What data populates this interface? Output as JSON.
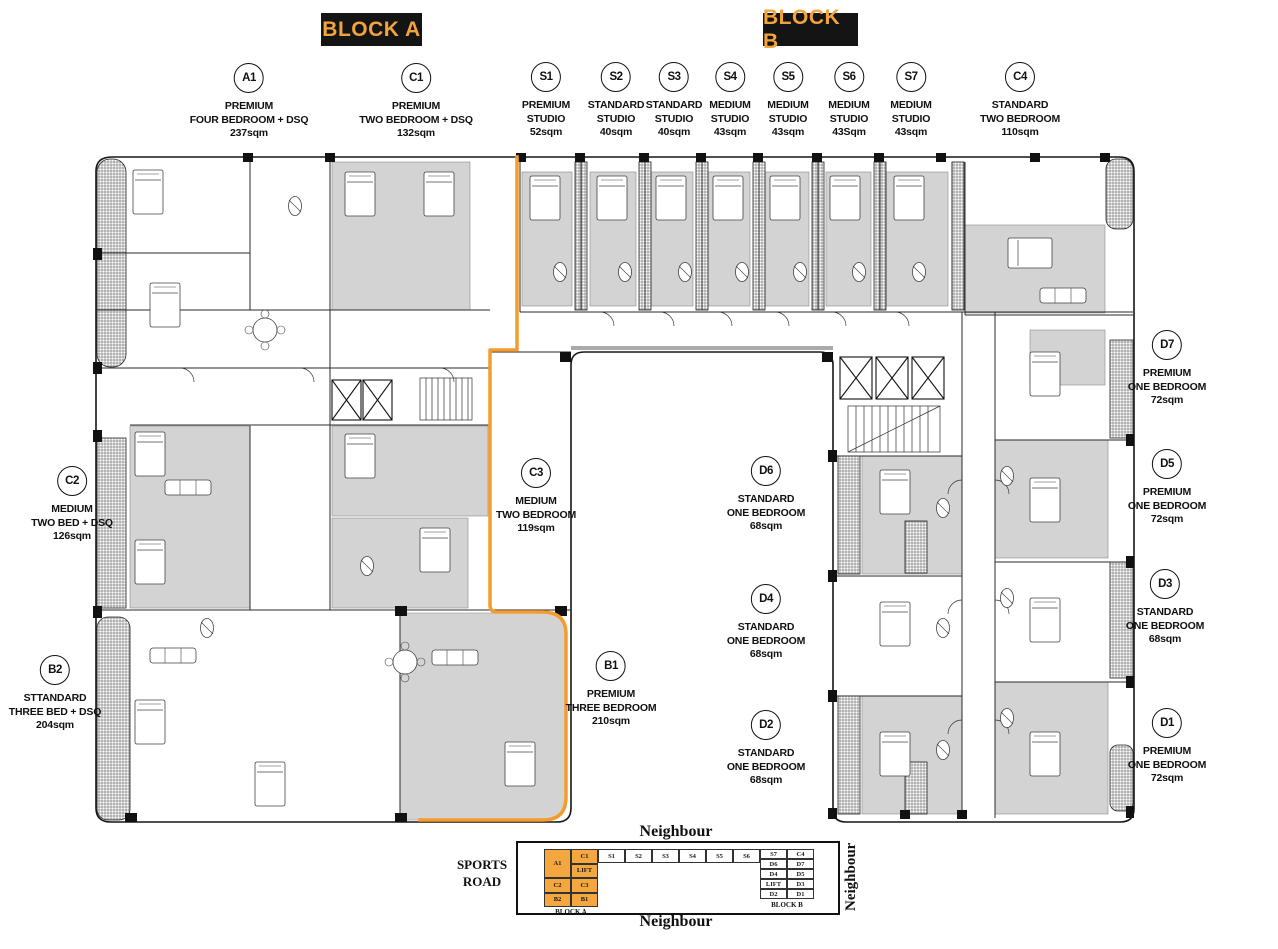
{
  "poster": {
    "block_a_header": "BLOCK A",
    "block_b_header": "BLOCK B"
  },
  "colors": {
    "header_bg": "#141414",
    "accent_orange": "#F2A33C",
    "highlight_orange": "#F59C2F",
    "keyplan_orange": "#F3A73E",
    "plan_room_gray": "#D3D3D3"
  },
  "units": [
    {
      "code": "A1",
      "lines": [
        "PREMIUM",
        "FOUR BEDROOM + DSQ",
        "237sqm"
      ]
    },
    {
      "code": "C1",
      "lines": [
        "PREMIUM",
        "TWO BEDROOM + DSQ",
        "132sqm"
      ]
    },
    {
      "code": "S1",
      "lines": [
        "PREMIUM",
        "STUDIO",
        "52sqm"
      ]
    },
    {
      "code": "S2",
      "lines": [
        "STANDARD",
        "STUDIO",
        "40sqm"
      ]
    },
    {
      "code": "S3",
      "lines": [
        "STANDARD",
        "STUDIO",
        "40sqm"
      ]
    },
    {
      "code": "S4",
      "lines": [
        "MEDIUM",
        "STUDIO",
        "43sqm"
      ]
    },
    {
      "code": "S5",
      "lines": [
        "MEDIUM",
        "STUDIO",
        "43sqm"
      ]
    },
    {
      "code": "S6",
      "lines": [
        "MEDIUM",
        "STUDIO",
        "43Sqm"
      ]
    },
    {
      "code": "S7",
      "lines": [
        "MEDIUM",
        "STUDIO",
        "43sqm"
      ]
    },
    {
      "code": "C4",
      "lines": [
        "STANDARD",
        "TWO BEDROOM",
        "110sqm"
      ]
    },
    {
      "code": "C2",
      "lines": [
        "MEDIUM",
        "TWO BED + DSQ",
        "126sqm"
      ]
    },
    {
      "code": "B2",
      "lines": [
        "STTANDARD",
        "THREE BED + DSQ",
        "204sqm"
      ]
    },
    {
      "code": "C3",
      "lines": [
        "MEDIUM",
        "TWO BEDROOM",
        "119sqm"
      ]
    },
    {
      "code": "B1",
      "lines": [
        "PREMIUM",
        "THREE BEDROOM",
        "210sqm"
      ]
    },
    {
      "code": "D6",
      "lines": [
        "STANDARD",
        "ONE BEDROOM",
        "68sqm"
      ]
    },
    {
      "code": "D4",
      "lines": [
        "STANDARD",
        "ONE BEDROOM",
        "68sqm"
      ]
    },
    {
      "code": "D2",
      "lines": [
        "STANDARD",
        "ONE BEDROOM",
        "68sqm"
      ]
    },
    {
      "code": "D7",
      "lines": [
        "PREMIUM",
        "ONE BEDROOM",
        "72sqm"
      ]
    },
    {
      "code": "D5",
      "lines": [
        "PREMIUM",
        "ONE BEDROOM",
        "72sqm"
      ]
    },
    {
      "code": "D3",
      "lines": [
        "STANDARD",
        "ONE BEDROOM",
        "68sqm"
      ]
    },
    {
      "code": "D1",
      "lines": [
        "PREMIUM",
        "ONE BEDROOM",
        "72sqm"
      ]
    }
  ],
  "key_plan": {
    "neighbour_top": "Neighbour",
    "neighbour_bottom": "Neighbour",
    "neighbour_right": "Neighbour",
    "sports_road_lines": [
      "SPORTS",
      "ROAD"
    ],
    "block_a_caption": "BLOCK A",
    "block_b_caption": "BLOCK B",
    "block_a_cells": {
      "a1": "A1",
      "c1": "C1",
      "lift": "LIFT",
      "c2": "C2",
      "c3": "C3",
      "b2": "B2",
      "b1": "B1"
    },
    "s_row": [
      "S1",
      "S2",
      "S3",
      "S4",
      "S5",
      "S6"
    ],
    "block_b_rows": [
      [
        "S7",
        "C4"
      ],
      [
        "D6",
        "D7"
      ],
      [
        "D4",
        "D5"
      ],
      [
        "LIFT",
        "D3"
      ],
      [
        "D2",
        "D1"
      ]
    ]
  }
}
